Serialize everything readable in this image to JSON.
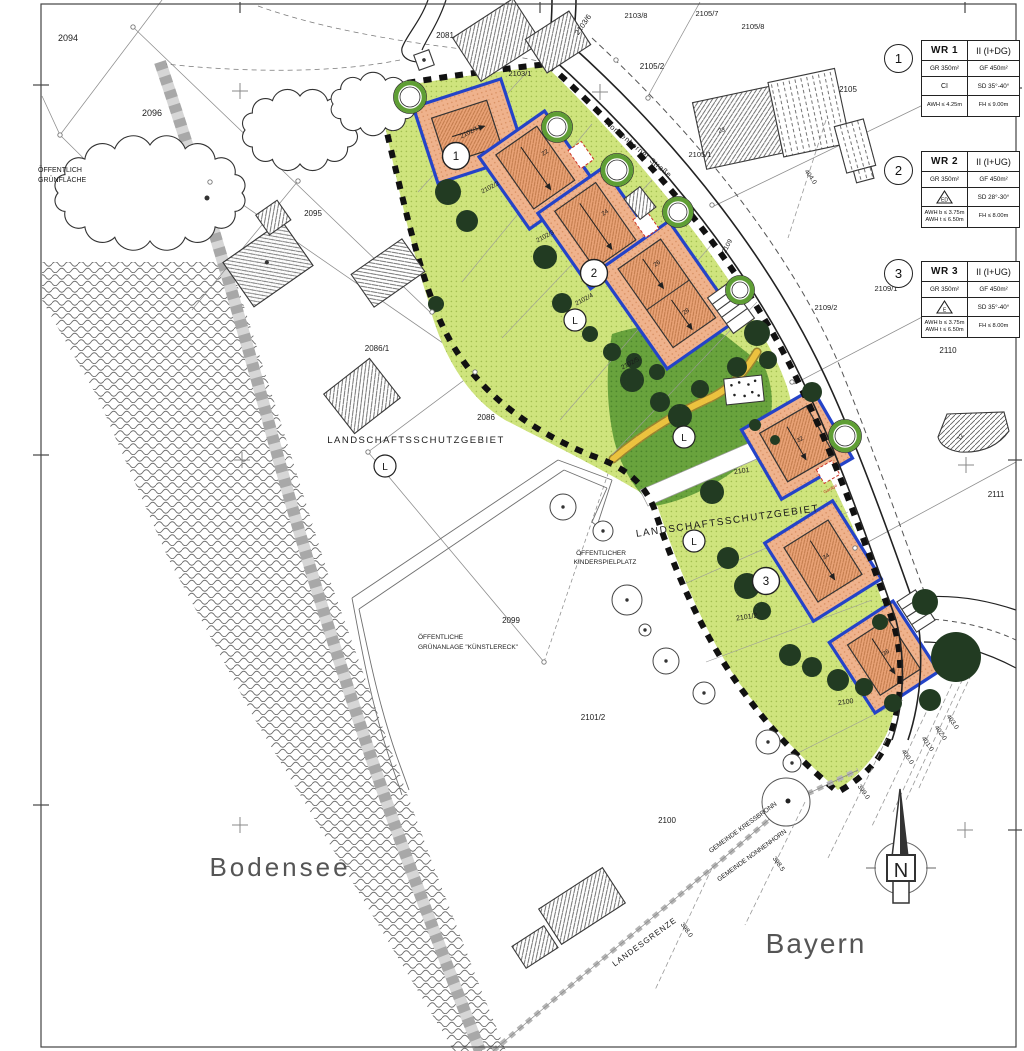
{
  "legend": {
    "boxes": [
      {
        "num": "1",
        "zone": "WR 1",
        "floors": "II (I+DG)",
        "gr": "GR 350m²",
        "gf": "GF 450m²",
        "form": "CI",
        "triangle": false,
        "roof": "SD 35°-40°",
        "awh1": "AWH ≤ 4.25m",
        "awh2": "",
        "fh": "FH ≤ 9.00m"
      },
      {
        "num": "2",
        "zone": "WR 2",
        "floors": "II (I+UG)",
        "gr": "GR 350m²",
        "gf": "GF 450m²",
        "form": "ED",
        "triangle": true,
        "roof": "SD 28°-30°",
        "awh1": "AWH b ≤ 3.75m",
        "awh2": "AWH t ≤ 6.50m",
        "fh": "FH ≤ 8.00m"
      },
      {
        "num": "3",
        "zone": "WR 3",
        "floors": "II (I+UG)",
        "gr": "GR 350m²",
        "gf": "GF 450m²",
        "form": "E",
        "triangle": true,
        "roof": "SD 35°-40°",
        "awh1": "AWH b ≤ 3.75m",
        "awh2": "AWH t ≤ 6.50m",
        "fh": "FH ≤ 8.00m"
      }
    ]
  },
  "map": {
    "colors": {
      "lime": "#cfe47d",
      "playground_green": "#69a33d",
      "tree_dark": "#223b22",
      "plot_orange": "#efb28c",
      "baufenster_blue": "#2443c8",
      "boundary_black": "#111111",
      "yellow_path": "#e8bc3e",
      "garage_red": "#cc3326"
    },
    "markers": {
      "zone_numbers": [
        {
          "label": "1",
          "x": 456,
          "y": 156
        },
        {
          "label": "2",
          "x": 594,
          "y": 273
        },
        {
          "label": "3",
          "x": 766,
          "y": 581
        }
      ],
      "l_circles": [
        {
          "label": "L",
          "x": 385,
          "y": 466
        },
        {
          "label": "L",
          "x": 575,
          "y": 320
        },
        {
          "label": "L",
          "x": 684,
          "y": 437
        },
        {
          "label": "L",
          "x": 694,
          "y": 541
        }
      ]
    },
    "labels": [
      {
        "name": "parcel-2094",
        "text": "2094",
        "x": 68,
        "y": 41,
        "size": 9
      },
      {
        "name": "parcel-2096",
        "text": "2096",
        "x": 152,
        "y": 116,
        "size": 9
      },
      {
        "name": "label-gruenflaeche-1",
        "text": "ÖFFENTLICH",
        "x": 38,
        "y": 172,
        "size": 7,
        "anchor": "start"
      },
      {
        "name": "label-gruenflaeche-2",
        "text": "GRÜNFLÄCHE",
        "x": 38,
        "y": 182,
        "size": 7,
        "anchor": "start"
      },
      {
        "name": "parcel-2095",
        "text": "2095",
        "x": 313,
        "y": 216,
        "size": 8
      },
      {
        "name": "parcel-2081",
        "text": "2081",
        "x": 445,
        "y": 38,
        "size": 8
      },
      {
        "name": "parcel-2103-6",
        "text": "2103/6",
        "x": 585,
        "y": 26,
        "size": 7.5,
        "rot": -55
      },
      {
        "name": "parcel-2103-8",
        "text": "2103/8",
        "x": 636,
        "y": 18,
        "size": 7.5
      },
      {
        "name": "parcel-2105-7",
        "text": "2105/7",
        "x": 707,
        "y": 16,
        "size": 7.5
      },
      {
        "name": "parcel-2105-8",
        "text": "2105/8",
        "x": 753,
        "y": 29,
        "size": 7.5
      },
      {
        "name": "parcel-2105-2",
        "text": "2105/2",
        "x": 652,
        "y": 69,
        "size": 8
      },
      {
        "name": "parcel-2105",
        "text": "2105",
        "x": 848,
        "y": 92,
        "size": 8
      },
      {
        "name": "parcel-2103-1",
        "text": "2103/1",
        "x": 520,
        "y": 76,
        "size": 7.5
      },
      {
        "name": "parcel-2105-1",
        "text": "2105/1",
        "x": 700,
        "y": 157,
        "size": 7.5
      },
      {
        "name": "street-name",
        "text": "Nonnenhorner Straße",
        "x": 637,
        "y": 151,
        "size": 7.5,
        "rot": 40,
        "spacing": 0.6
      },
      {
        "name": "elev-404",
        "text": "404.0",
        "x": 809,
        "y": 178,
        "size": 6.5,
        "rot": 55
      },
      {
        "name": "parcel-2102-1",
        "text": "2102/1",
        "x": 470,
        "y": 134,
        "size": 6.3,
        "rot": -28
      },
      {
        "name": "parcel-2102-2",
        "text": "2102/2",
        "x": 491,
        "y": 189,
        "size": 6.3,
        "rot": -28
      },
      {
        "name": "parcel-2102-3",
        "text": "2102/3",
        "x": 546,
        "y": 238,
        "size": 6.3,
        "rot": -28
      },
      {
        "name": "parcel-2102-4",
        "text": "2102/4",
        "x": 585,
        "y": 301,
        "size": 6.3,
        "rot": -28
      },
      {
        "name": "parcel-2102-5",
        "text": "2102/5",
        "x": 631,
        "y": 365,
        "size": 6.3,
        "rot": -28
      },
      {
        "name": "parcel-2109",
        "text": "2109",
        "x": 729,
        "y": 247,
        "size": 6.5,
        "rot": -62
      },
      {
        "name": "parcel-2109-2",
        "text": "2109/2",
        "x": 826,
        "y": 310,
        "size": 7.5
      },
      {
        "name": "parcel-2109-1",
        "text": "2109/1",
        "x": 886,
        "y": 291,
        "size": 7.5
      },
      {
        "name": "parcel-2110",
        "text": "2110",
        "x": 948,
        "y": 353,
        "size": 8
      },
      {
        "name": "parcel-2086-1",
        "text": "2086/1",
        "x": 377,
        "y": 351,
        "size": 8
      },
      {
        "name": "parcel-2086",
        "text": "2086",
        "x": 486,
        "y": 420,
        "size": 8
      },
      {
        "name": "label-lsg-1",
        "text": "LANDSCHAFTSSCHUTZGEBIET",
        "x": 416,
        "y": 443,
        "size": 9.5,
        "spacing": 1.5
      },
      {
        "name": "parcel-2111",
        "text": "2111",
        "x": 996,
        "y": 497,
        "size": 8
      },
      {
        "name": "parcel-2101",
        "text": "2101",
        "x": 742,
        "y": 473,
        "size": 7,
        "rot": -8
      },
      {
        "name": "label-lsg-2",
        "text": "LANDSCHAFTSSCHUTZGEBIET",
        "x": 728,
        "y": 524,
        "size": 10,
        "rot": -8,
        "spacing": 1.5
      },
      {
        "name": "label-kinderspielplatz-1",
        "text": "ÖFFENTLICHER",
        "x": 601,
        "y": 555,
        "size": 6.5
      },
      {
        "name": "label-kinderspielplatz-2",
        "text": "KINDERSPIELPLATZ",
        "x": 605,
        "y": 564,
        "size": 6.5
      },
      {
        "name": "parcel-2099",
        "text": "2099",
        "x": 511,
        "y": 623,
        "size": 8
      },
      {
        "name": "label-kuenstlereck-1",
        "text": "ÖFFENTLICHE",
        "x": 418,
        "y": 639,
        "size": 6.5,
        "anchor": "start"
      },
      {
        "name": "label-kuenstlereck-2",
        "text": "GRÜNANLAGE  \"KÜNSTLERECK\"",
        "x": 418,
        "y": 649,
        "size": 6.5,
        "anchor": "start"
      },
      {
        "name": "parcel-2101-2a",
        "text": "2101/2",
        "x": 747,
        "y": 619,
        "size": 7,
        "rot": -8
      },
      {
        "name": "parcel-2101-2b",
        "text": "2101/2",
        "x": 593,
        "y": 720,
        "size": 8
      },
      {
        "name": "parcel-2100a",
        "text": "2100",
        "x": 846,
        "y": 704,
        "size": 7,
        "rot": -8
      },
      {
        "name": "parcel-2100b",
        "text": "2100",
        "x": 667,
        "y": 823,
        "size": 8
      },
      {
        "name": "elev-403",
        "text": "403.0",
        "x": 951,
        "y": 723,
        "size": 6.5,
        "rot": 55
      },
      {
        "name": "elev-402",
        "text": "402.0",
        "x": 939,
        "y": 734,
        "size": 6.5,
        "rot": 55
      },
      {
        "name": "elev-401",
        "text": "401.0",
        "x": 926,
        "y": 745,
        "size": 6.5,
        "rot": 55
      },
      {
        "name": "elev-400",
        "text": "400.0",
        "x": 906,
        "y": 758,
        "size": 6.5,
        "rot": 55
      },
      {
        "name": "elev-399",
        "text": "399.0",
        "x": 862,
        "y": 793,
        "size": 6.5,
        "rot": 55
      },
      {
        "name": "elev-398-5",
        "text": "398.5",
        "x": 777,
        "y": 865,
        "size": 6.5,
        "rot": 55
      },
      {
        "name": "elev-398",
        "text": "398.0",
        "x": 685,
        "y": 931,
        "size": 6.5,
        "rot": 55
      },
      {
        "name": "label-gemeinde-kressbronn",
        "text": "GEMEINDE KRESSBRONN",
        "x": 744,
        "y": 829,
        "size": 6.5,
        "rot": -36
      },
      {
        "name": "label-gemeinde-nonnenhorn",
        "text": "GEMEINDE NONNENHORN",
        "x": 753,
        "y": 857,
        "size": 6.5,
        "rot": -36
      },
      {
        "name": "label-landesgrenze",
        "text": "LANDESGRENZE",
        "x": 646,
        "y": 944,
        "size": 8,
        "rot": -36,
        "spacing": 1
      },
      {
        "name": "label-bodensee",
        "text": "Bodensee",
        "x": 280,
        "y": 876,
        "size": 26,
        "color": "#555",
        "spacing": 3
      },
      {
        "name": "label-bayern",
        "text": "Bayern",
        "x": 816,
        "y": 953,
        "size": 28,
        "color": "#555",
        "spacing": 2
      },
      {
        "name": "north-letter",
        "text": "N",
        "x": 901,
        "y": 877,
        "size": 20,
        "color": "#222"
      },
      {
        "name": "house-22",
        "text": "22",
        "x": 546,
        "y": 154,
        "size": 6,
        "rot": -35
      },
      {
        "name": "house-24",
        "text": "24",
        "x": 606,
        "y": 214,
        "size": 6,
        "rot": -35
      },
      {
        "name": "house-26",
        "text": "26",
        "x": 658,
        "y": 265,
        "size": 6,
        "rot": -35
      },
      {
        "name": "house-28",
        "text": "28",
        "x": 687,
        "y": 313,
        "size": 6,
        "rot": -35
      },
      {
        "name": "house-32",
        "text": "32",
        "x": 801,
        "y": 441,
        "size": 6,
        "rot": -30
      },
      {
        "name": "house-34",
        "text": "34",
        "x": 827,
        "y": 558,
        "size": 6,
        "rot": -32
      },
      {
        "name": "house-36",
        "text": "36",
        "x": 887,
        "y": 654,
        "size": 6,
        "rot": -33
      },
      {
        "name": "house-23",
        "text": "23",
        "x": 722,
        "y": 132,
        "size": 6,
        "rot": -12
      },
      {
        "name": "house-12",
        "text": "12",
        "x": 962,
        "y": 438,
        "size": 6,
        "rot": -60
      },
      {
        "name": "label-garage",
        "text": "Garage",
        "x": 831,
        "y": 490,
        "size": 4.5,
        "rot": -30,
        "color": "#c0392b"
      }
    ]
  }
}
